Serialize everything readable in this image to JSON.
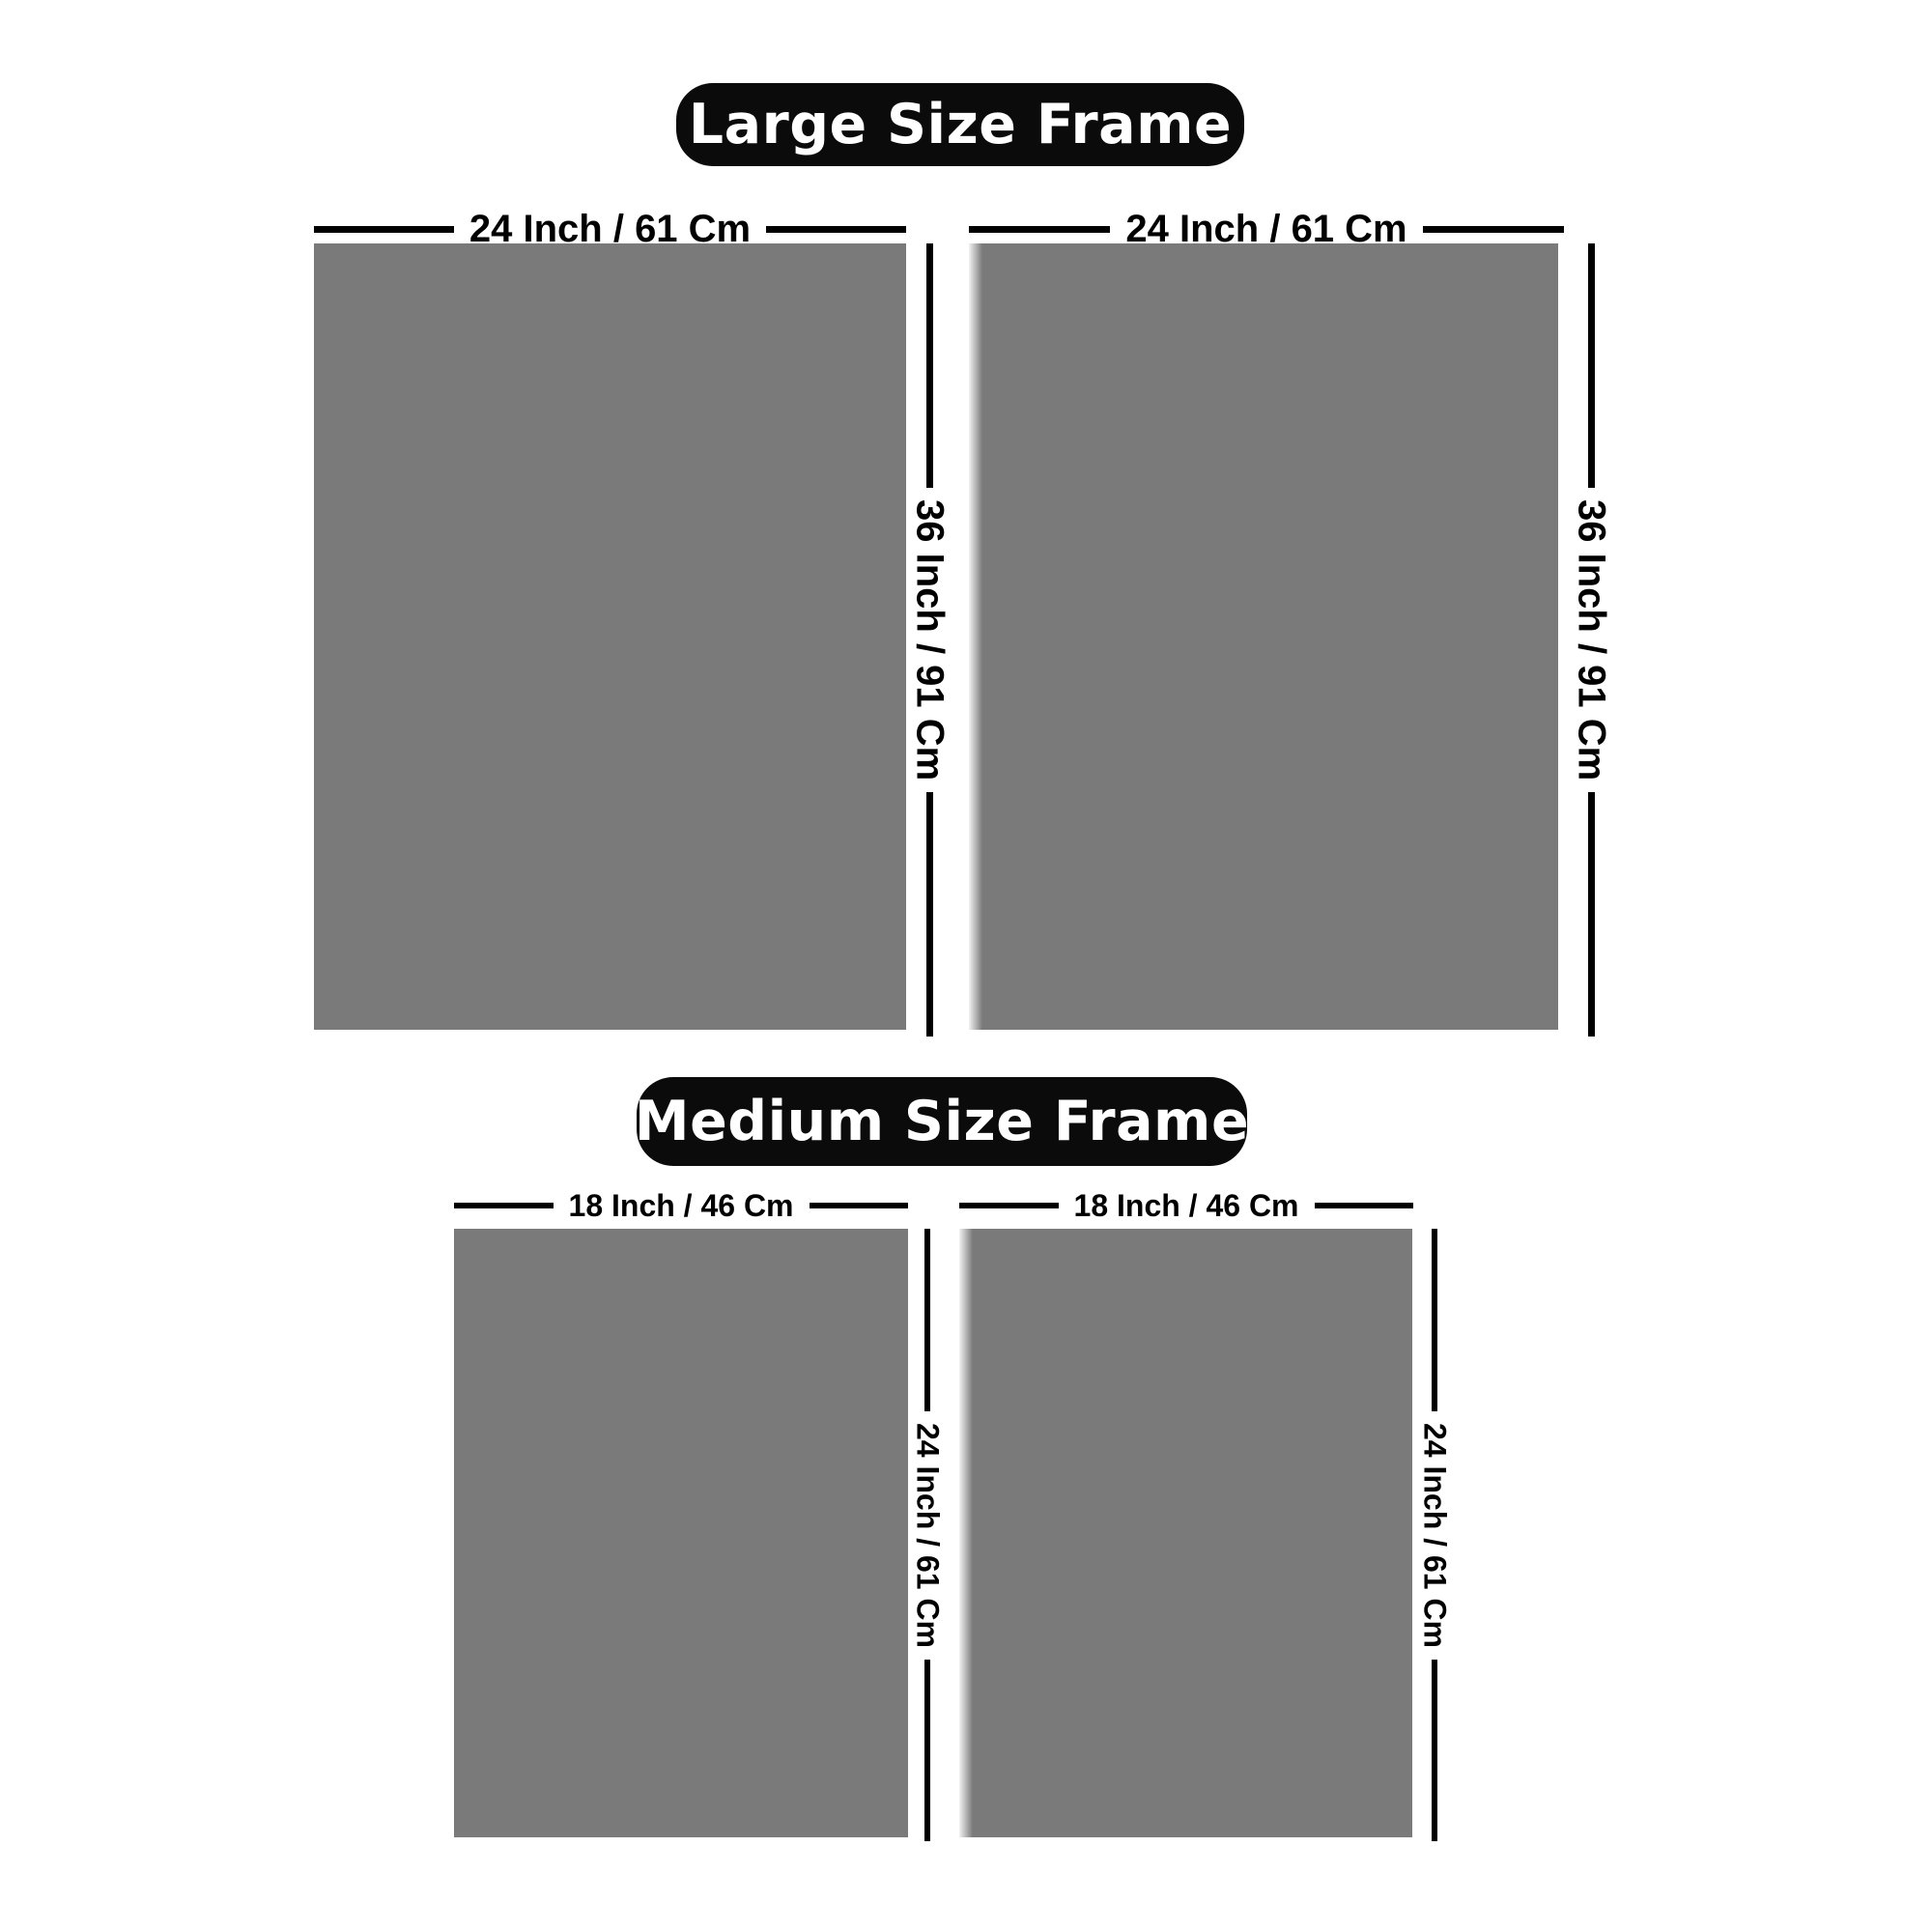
{
  "page": {
    "background": "#ffffff"
  },
  "colors": {
    "frame_fill": "#7a7a7a",
    "pill_background": "#0b0b0b",
    "pill_text": "#ffffff",
    "dimension_line": "#000000",
    "dimension_text": "#000000"
  },
  "sections": [
    {
      "id": "large",
      "title": "Large Size Frame",
      "width_label": "24 Inch / 61 Cm",
      "height_label": "36 Inch / 91 Cm"
    },
    {
      "id": "medium",
      "title": "Medium Size Frame",
      "width_label": "18 Inch / 46 Cm",
      "height_label": "24 Inch / 61 Cm"
    }
  ]
}
